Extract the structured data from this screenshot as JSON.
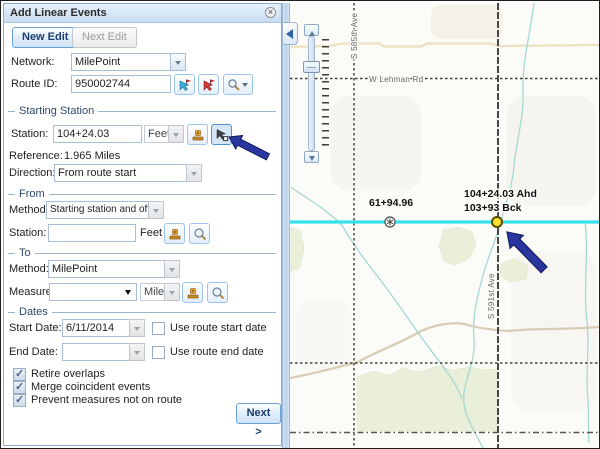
{
  "panel": {
    "title": "Add Linear Events",
    "new_edit": "New Edit",
    "next_edit": "Next Edit",
    "network_label": "Network:",
    "network_value": "MilePoint",
    "route_id_label": "Route ID:",
    "route_id_value": "950002744",
    "section_starting_station": "Starting Station",
    "station_label": "Station:",
    "station_value": "104+24.03",
    "station_units": "Feet",
    "reference_label": "Reference:",
    "reference_value": "1.965 Miles",
    "direction_label": "Direction:",
    "direction_value": "From route start",
    "section_from": "From",
    "from_method_label": "Method:",
    "from_method_value": "Starting station and offset",
    "from_station_label": "Station:",
    "from_station_value": "",
    "from_station_units": "Feet",
    "section_to": "To",
    "to_method_label": "Method:",
    "to_method_value": "MilePoint",
    "measure_label": "Measure:",
    "measure_value": "",
    "measure_units": "Miles",
    "section_dates": "Dates",
    "start_date_label": "Start Date:",
    "start_date_value": "6/11/2014",
    "use_route_start_label": "Use route start date",
    "end_date_label": "End Date:",
    "end_date_value": "",
    "use_route_end_label": "Use route end date",
    "options": [
      "Retire overlaps",
      "Merge coincident events",
      "Prevent measures not on route"
    ],
    "next_button": "Next >"
  },
  "icons": {
    "close": "×"
  },
  "map": {
    "road_v1_label": "S 585th Ave",
    "road_h1_label": "W Lehman Rd",
    "road_v2_label": "S 591st Ave",
    "station_marker_label": "61+94.96",
    "selected_point_label_line1": "104+24.03 Ahd",
    "selected_point_label_line2": "103+93 Bck"
  },
  "colors": {
    "route_line": "#35e2e9",
    "selected_point_fill": "#ffdf29",
    "annotation_arrow": "#2a36a0",
    "panel_accent": "#c7dcf1"
  }
}
